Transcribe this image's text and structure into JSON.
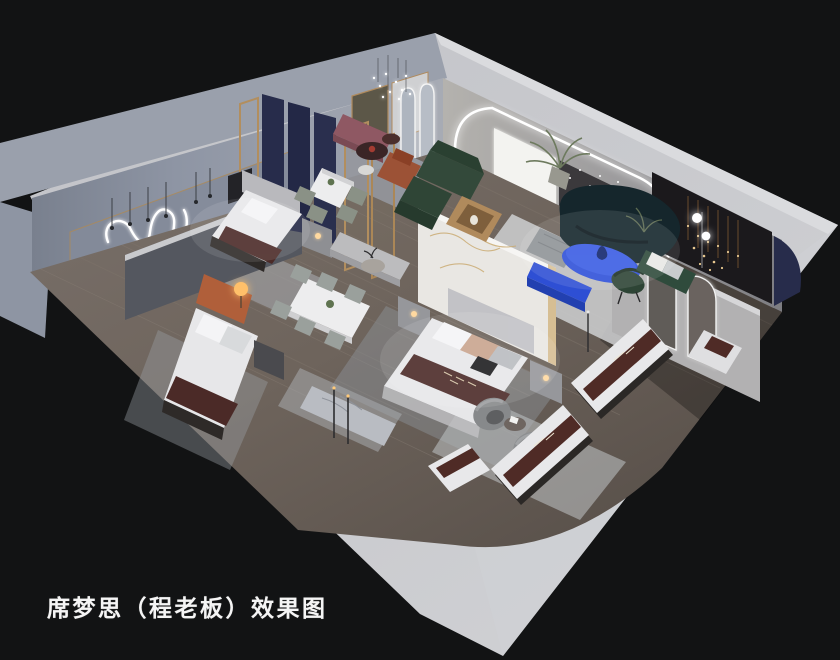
{
  "caption": {
    "text": "席梦思（程老板）效果图"
  },
  "scene": {
    "kind": "3d-axonometric-interior-render",
    "objects": [
      "neon-squiggle-wall-art",
      "pendant-bulb-lights",
      "cluster-chandelier",
      "bed-display",
      "double-bed",
      "mattress-display",
      "nightstand",
      "dining-table-marble",
      "dining-chairs",
      "lounge-bench-mauve",
      "round-coffee-table",
      "rust-armchair",
      "green-sectional-sofa",
      "teal-curved-sofa",
      "blue-oval-coffee-table",
      "blue-tv-console",
      "gray-ottoman",
      "fan-back-chair",
      "floor-lamp-globes",
      "palm-plant",
      "arched-led-mirror",
      "arched-doorway-partition",
      "marble-partition",
      "navy-fabric-panels",
      "wood-frame-glass-partition",
      "dark-feature-wall-string-lights",
      "barrel-swivel-chairs",
      "area-rug"
    ]
  },
  "palette": {
    "background": "#1a1b1d",
    "outer_wall": "#c8c9cd",
    "wall_top": "#d9dadd",
    "nw_wall_face": "#8e95a4",
    "floor_wood": "#6e645c",
    "led_white": "#ffffff",
    "navy_panel": "#272c4b",
    "accent_blue": "#2e50d8",
    "sofa_green": "#33493a",
    "sofa_teal": "#15262c",
    "runner_maroon": "#4b2a27",
    "bench_mauve": "#8f5863",
    "chair_rust": "#9c5236",
    "wood_gold": "#b08a5c",
    "feature_wall_dark": "#1b191c"
  }
}
